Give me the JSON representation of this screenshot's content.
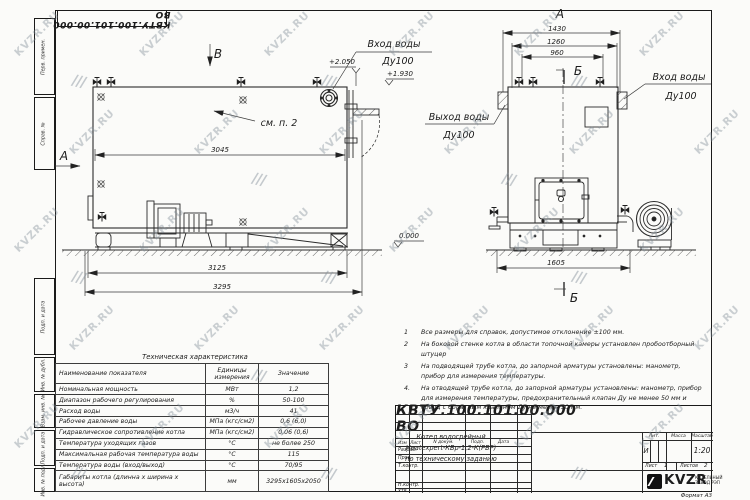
{
  "sheet": {
    "doc_number": "КВТУ.100.101.00.000  ВО",
    "watermark_text": "KVZR.RU",
    "watermark_logo": "///",
    "format_label": "Формат  А3",
    "side_labels": [
      "Перв. примен.",
      "Справ. №",
      "Подп. и дата",
      "Инв. № дубл.",
      "Взам. инв. №",
      "Подп. и дата",
      "Инв. № подл."
    ]
  },
  "views": {
    "left": {
      "view_label": "В",
      "section_label": "А",
      "see_note": "см. п. 2",
      "dim_top": "3045",
      "dim_mid": "3125",
      "dim_total": "3295",
      "elev1": "+2.050",
      "elev2": "+1.930",
      "inlet_line1": "Вход воды",
      "inlet_line2": "Ду100"
    },
    "right": {
      "view_label": "А",
      "section_label_top": "Б",
      "section_label_bottom": "Б",
      "dim1": "1430",
      "dim2": "1260",
      "dim3": "960",
      "dim_base": "1605",
      "elev_zero": "0.000",
      "outlet_line1": "Выход воды",
      "outlet_line2": "Ду100",
      "inlet_line1": "Вход воды",
      "inlet_line2": "Ду100"
    }
  },
  "notes": [
    {
      "num": "1",
      "text": "Все размеры для справок, допустимое отклонение  ±100 мм."
    },
    {
      "num": "2",
      "text": "На боковой стенке котла в области топочной камеры установлен пробоотборный штуцер"
    },
    {
      "num": "3",
      "text": "На  подводящей трубе котла, до запорной арматуры установлены: манометр, прибор для измерения температуры."
    },
    {
      "num": "4.",
      "text": "На отводящей трубе котла, до запорной арматуры установлены: манометр, прибор для измерения температуры, предохранительный клапан Ду не менее 50 мм и обвод с обратным клапаном Ду не менее 50 мм."
    }
  ],
  "spec_table": {
    "title": "Техническая характеристика",
    "headers": [
      "Наименование показателя",
      "Единицы измерения",
      "Значение"
    ],
    "rows": [
      [
        "Номинальная мощность",
        "МВт",
        "1,2"
      ],
      [
        "Диапазон рабочего регулирования",
        "%",
        "50-100"
      ],
      [
        "Расход воды",
        "м3/ч",
        "41"
      ],
      [
        "Рабочее давление воды",
        "МПа (кгс/см2)",
        "0,6 (6,0)"
      ],
      [
        "Гидравлическое сопротивление котла",
        "МПа (кгс/см2)",
        "0,06 (0,6)"
      ],
      [
        "Температура уходящих газов",
        "°С",
        "не более 250"
      ],
      [
        "Максимальная рабочая температура воды",
        "°С",
        "115"
      ],
      [
        "Температура воды (вход/выход)",
        "°С",
        "70/95"
      ],
      [
        "Габариты котла (длинна х ширина х высота)",
        "мм",
        "3295х1605х2050"
      ]
    ]
  },
  "title_block": {
    "doc_number": "КВТУ.100.101.00.000  ВО",
    "header_cols": [
      "Изм",
      "Лист",
      "N докум.",
      "Подп.",
      "Дата"
    ],
    "row_razrab": "Разраб.",
    "row_prov": "Пров.",
    "row_tkontr": "Т.контр.",
    "row_nkontr": "Н.контр.",
    "row_utv": "Утв.",
    "product_name_lines": [
      "Котел водогрейный",
      "Heatexpert-КВр-1,2-К(РВР)",
      "по техническому заданию"
    ],
    "lit_label": "Лит.",
    "mass_label": "Масса",
    "scale_label": "Масштаб",
    "lit_value": "И",
    "scale_value": "1:20",
    "sheet_label": "Лист",
    "sheet_value": "1",
    "sheets_label": "Листов",
    "sheets_value": "2",
    "company": {
      "logo": "KVZR",
      "name_line1": "КОТЕЛЬНЫЙ",
      "name_line2": "ЗАВОД РЭП"
    }
  }
}
